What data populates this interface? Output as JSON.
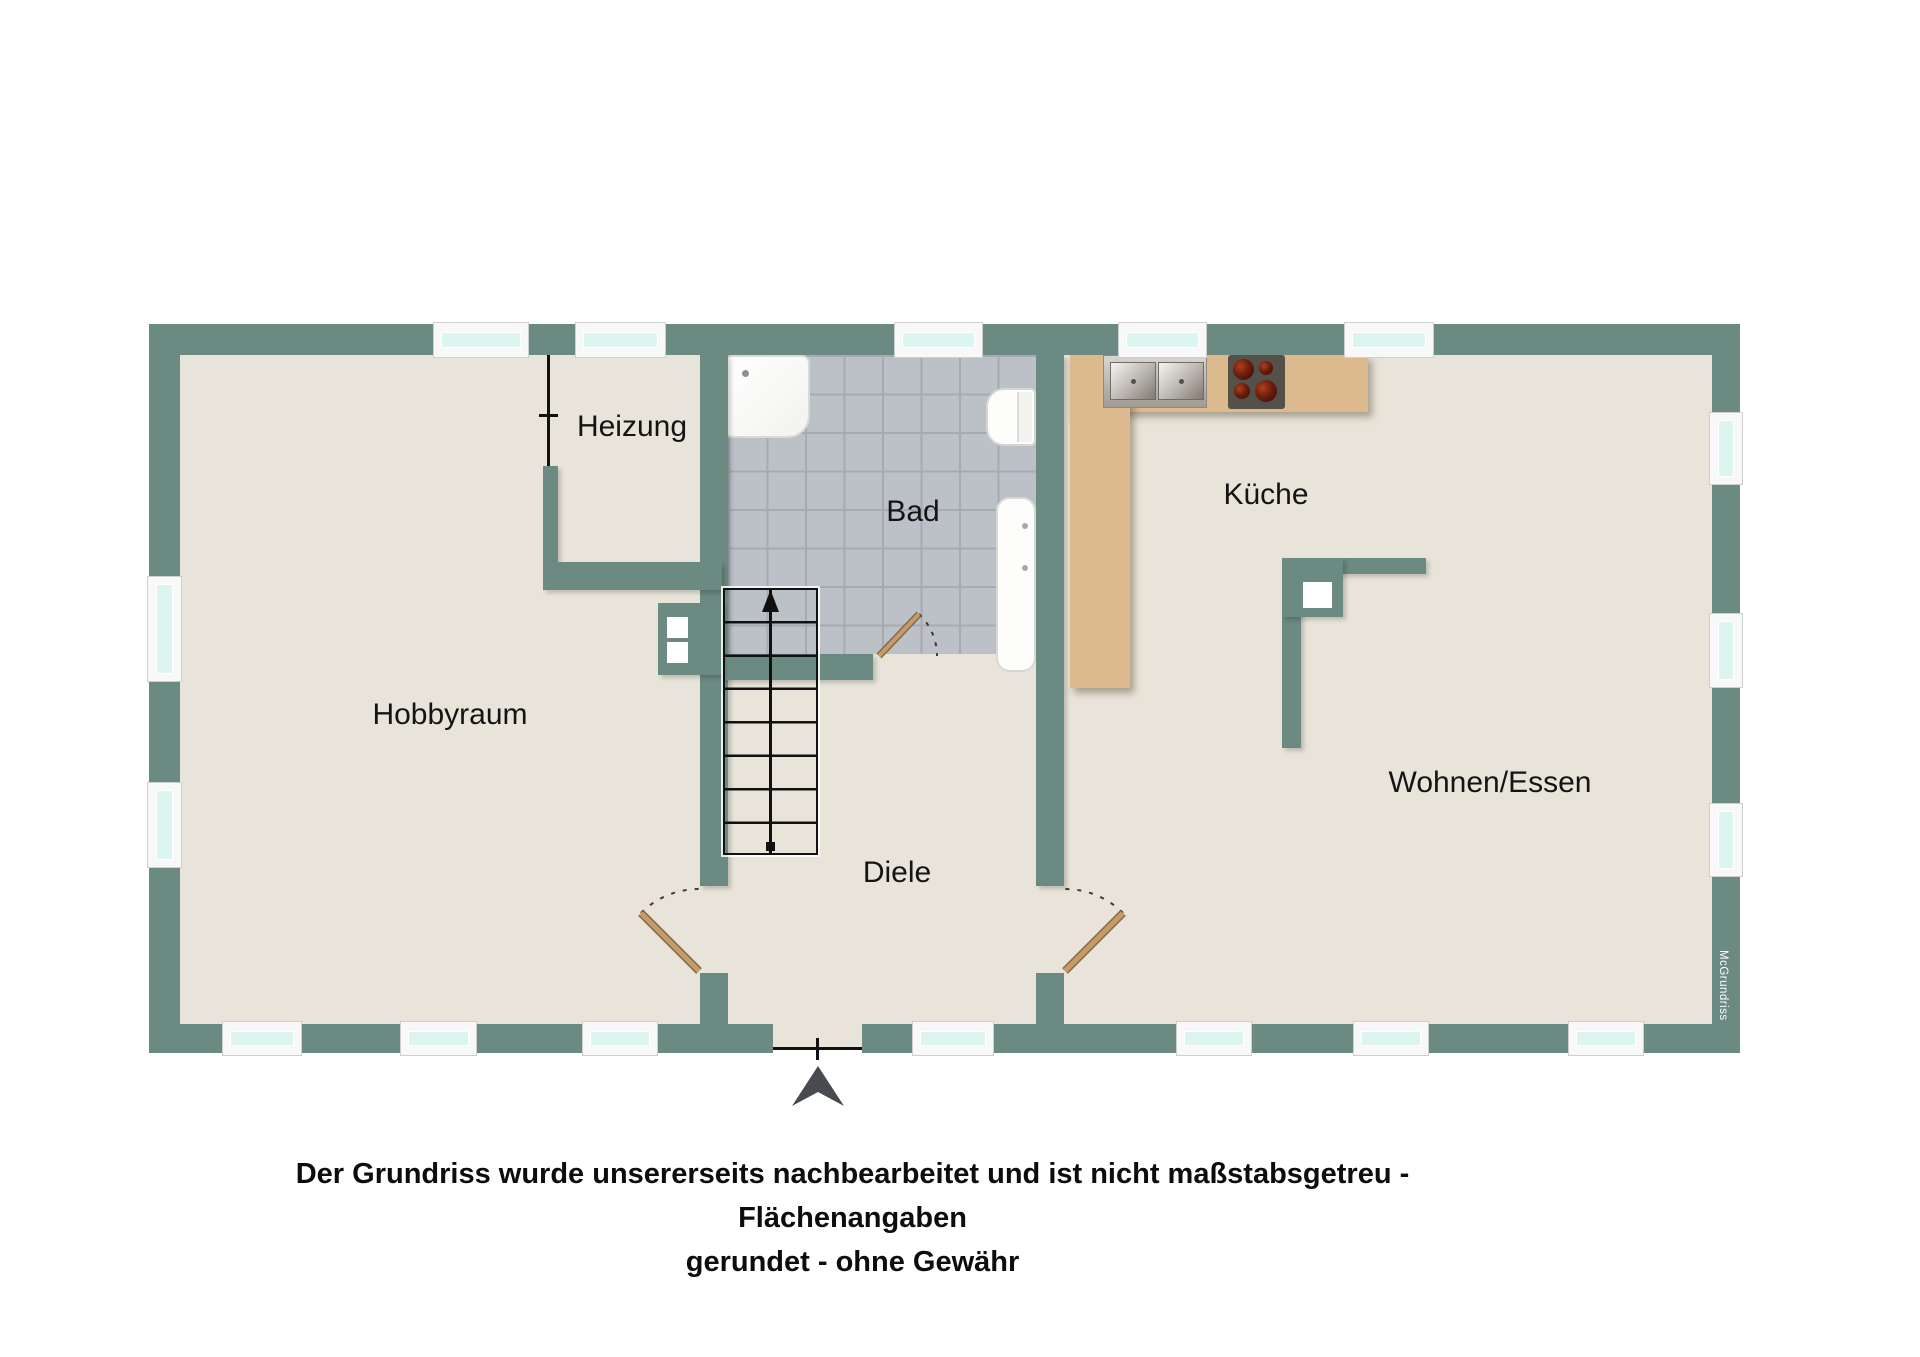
{
  "rooms": {
    "hobbyraum": {
      "label": "Hobbyraum"
    },
    "heizung": {
      "label": "Heizung"
    },
    "bad": {
      "label": "Bad"
    },
    "kueche": {
      "label": "Küche"
    },
    "wohnen_essen": {
      "label": "Wohnen/Essen"
    },
    "diele": {
      "label": "Diele"
    }
  },
  "watermark": {
    "label": "McGrundriss"
  },
  "disclaimer": {
    "line1": "Der Grundriss wurde unsererseits nachbearbeitet und ist nicht maßstabsgetreu - Flächenangaben",
    "line2": "gerundet - ohne Gewähr"
  },
  "colors": {
    "wall": "#6A8A82",
    "floor": "#E8E4D9",
    "tile": "#BCC0C7",
    "tile_line": "#A6AAB2",
    "counter": "#DDB98E",
    "window_pane": "#DCF5F1",
    "door_leaf": "#C59B6D",
    "entrance_arrow": "#474B4F"
  },
  "fixtures": {
    "names": [
      "shower-tray",
      "toilet",
      "bathtub",
      "double-sink",
      "cooktop",
      "stairs",
      "chimney",
      "heating-shaft",
      "entrance-door",
      "room-doors"
    ]
  }
}
